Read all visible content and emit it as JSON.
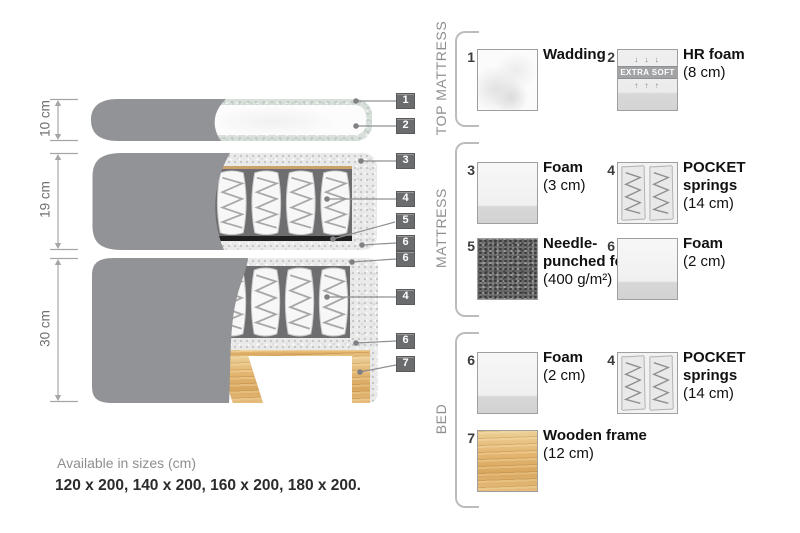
{
  "diagram": {
    "dimensions": [
      {
        "label": "10 cm"
      },
      {
        "label": "19 cm"
      },
      {
        "label": "30 cm"
      }
    ],
    "callouts": [
      "1",
      "2",
      "3",
      "4",
      "5",
      "6",
      "6",
      "4",
      "6",
      "7"
    ]
  },
  "legend": {
    "sections": [
      {
        "title": "TOP MATTRESS",
        "items": [
          {
            "num": "1",
            "title": "Wadding",
            "subtitle": ""
          },
          {
            "num": "2",
            "title": "HR foam",
            "subtitle": "(8 cm)",
            "badge": "EXTRA SOFT",
            "arrows_down": "↓ ↓ ↓",
            "arrows_up": "↑ ↑ ↑"
          }
        ]
      },
      {
        "title": "MATTRESS",
        "items": [
          {
            "num": "3",
            "title": "Foam",
            "subtitle": "(3 cm)"
          },
          {
            "num": "4",
            "title": "POCKET springs",
            "subtitle": "(14 cm)"
          },
          {
            "num": "5",
            "title": "Needle-punched felt",
            "subtitle": "(400 g/m²)"
          },
          {
            "num": "6",
            "title": "Foam",
            "subtitle": "(2 cm)"
          }
        ]
      },
      {
        "title": "BED",
        "items": [
          {
            "num": "6",
            "title": "Foam",
            "subtitle": "(2 cm)"
          },
          {
            "num": "4",
            "title": "POCKET springs",
            "subtitle": "(14 cm)"
          },
          {
            "num": "7",
            "title": "Wooden frame",
            "subtitle": "(12 cm)"
          }
        ]
      }
    ]
  },
  "footer": {
    "line1": "Available in sizes (cm)",
    "line2": "120 x 200, 140 x 200, 160 x 200, 180 x 200."
  },
  "colors": {
    "fabric_gray": "#929396",
    "wood_tan": "#e2b46e",
    "callout_box": "#6b6c6e",
    "felt_dark": "#686868"
  }
}
